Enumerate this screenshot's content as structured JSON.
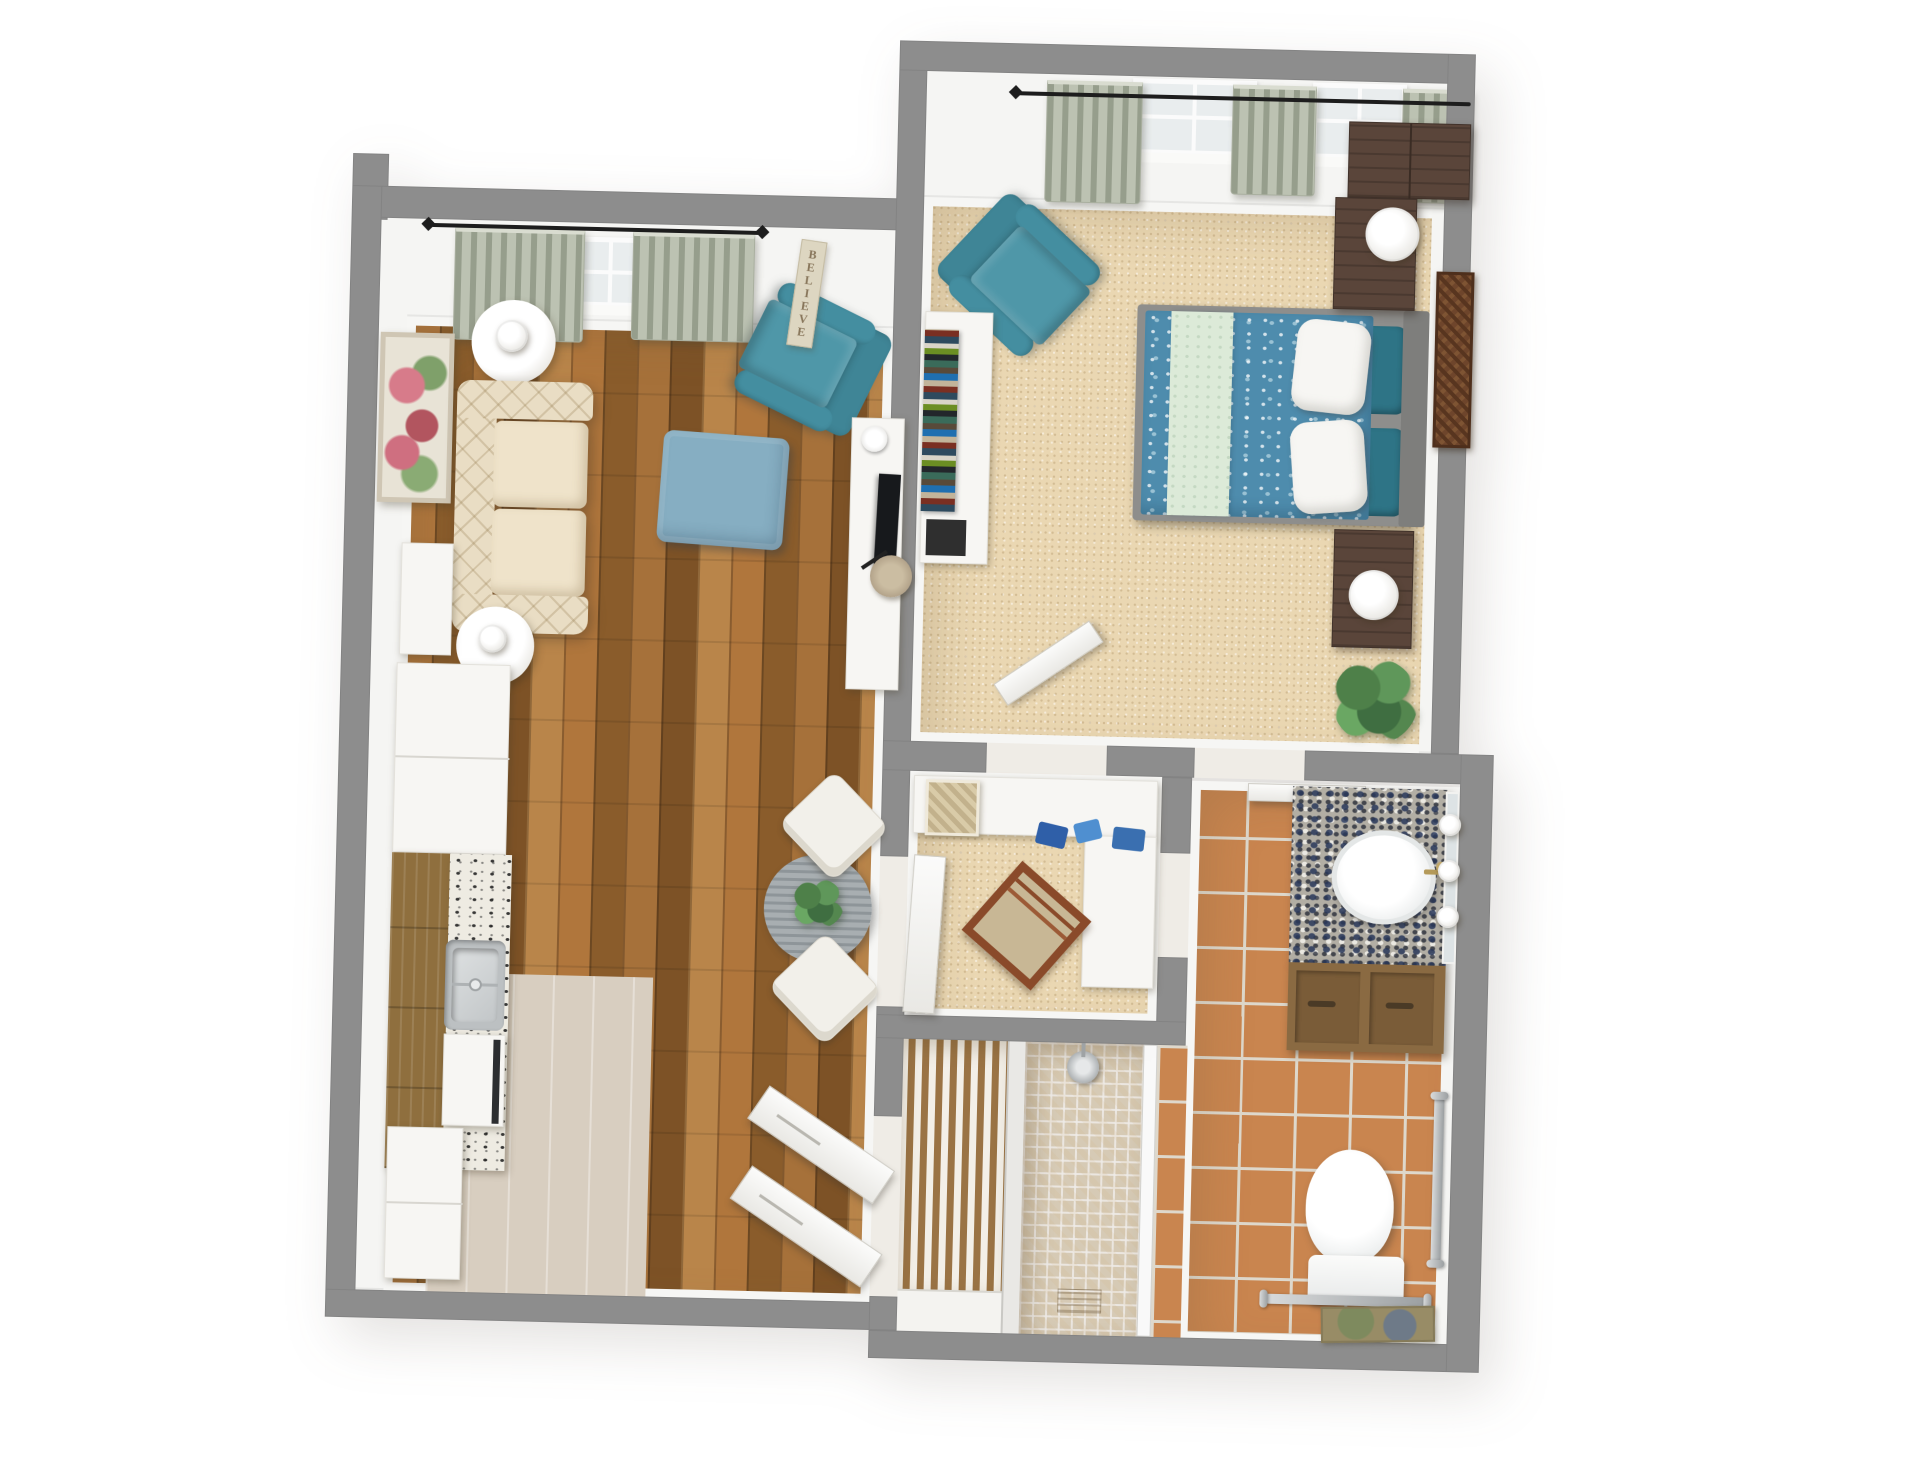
{
  "scene": {
    "description": "3D aerial dollhouse-view floor plan rendering of a one-bedroom apartment",
    "background": "#ffffff",
    "rendering_style": "photoreal top-down 3D"
  },
  "palette": {
    "wall_grey": "#8d8d8d",
    "wall_face_white": "#f5f5f3",
    "hardwood_floor": "#a06832",
    "carpet_beige": "#ead7b2",
    "terracotta_tile": "#c9854f",
    "mosaic_tile": "#e3d9c6",
    "pale_kitchen_floor": "#d8cec0",
    "teal_upholstery": "#4a90a2",
    "ottoman_blue": "#86aec2",
    "sofa_cream": "#e9ddc4",
    "bedspread_blue": "#4e8cad",
    "bedspread_mint": "#dcead8",
    "accent_pillow_teal": "#2e7486",
    "sage_curtain": "#bcc2b2",
    "kitchen_cabinet_wood": "#8f6f3e",
    "vanity_cabinet_wood": "#8a6a42",
    "dark_furniture_wood": "#5a453a",
    "metal_grab_bar": "#aeb2b4",
    "brass_faucet": "#b49a5a",
    "dining_table_grey": "#9aa1a5"
  },
  "living_room": {
    "name": "living-room-with-kitchen",
    "floor": "hardwood-planks",
    "believe_sign": "BELIEVE",
    "furniture": [
      "floral-wall-art",
      "round-side-table",
      "table-lamp",
      "tufted-cream-sofa",
      "round-side-table",
      "table-lamp",
      "teal-armchair",
      "blue-ottoman",
      "tv-console",
      "tv",
      "storage-basket",
      "round-dining-table",
      "table-plant",
      "dining-chair",
      "dining-chair",
      "white-console",
      "refrigerator",
      "kitchen-cabinets",
      "granite-counter",
      "kitchen-sink",
      "dishwasher",
      "base-cabinets",
      "entry-door-leaf",
      "entry-door-leaf",
      "window",
      "curtains",
      "curtain-rod"
    ]
  },
  "bedroom": {
    "name": "bedroom",
    "floor": "beige-carpet",
    "furniture": [
      "teal-armchair",
      "white-bookcase-console",
      "book-stack",
      "double-bed",
      "blue-floral-bedspread",
      "mint-accent-band",
      "white-pillows",
      "teal-pillows",
      "grey-headboard",
      "nightstand",
      "table-lamp",
      "nightstand",
      "table-lamp",
      "dark-wardrobe",
      "carved-wood-wall-art",
      "potted-plant",
      "open-door-leaf",
      "window",
      "window",
      "curtains",
      "curtain-rod"
    ]
  },
  "den": {
    "name": "den-office",
    "floor": "beige-carpet",
    "furniture": [
      "l-shaped-white-desk",
      "woven-basket",
      "blue-accessories",
      "wooden-chair",
      "open-door-leaf"
    ]
  },
  "closet": {
    "name": "louvered-closet",
    "floor": "wood-slat-shelving",
    "furniture": [
      "slatted-shelves",
      "white-base"
    ]
  },
  "shower_room": {
    "name": "walk-in-shower",
    "floor": "beige-mosaic-tile",
    "furniture": [
      "rain-shower-head",
      "glass-panel"
    ]
  },
  "bathroom": {
    "name": "bathroom",
    "floor": "terracotta-tile",
    "furniture": [
      "granite-vanity-counter",
      "oval-sink",
      "brass-faucet",
      "vanity-lights",
      "mirror",
      "wood-vanity-cabinet",
      "toilet",
      "vertical-grab-bar",
      "horizontal-grab-bar",
      "bath-mat",
      "sliding-door-leaf"
    ]
  }
}
